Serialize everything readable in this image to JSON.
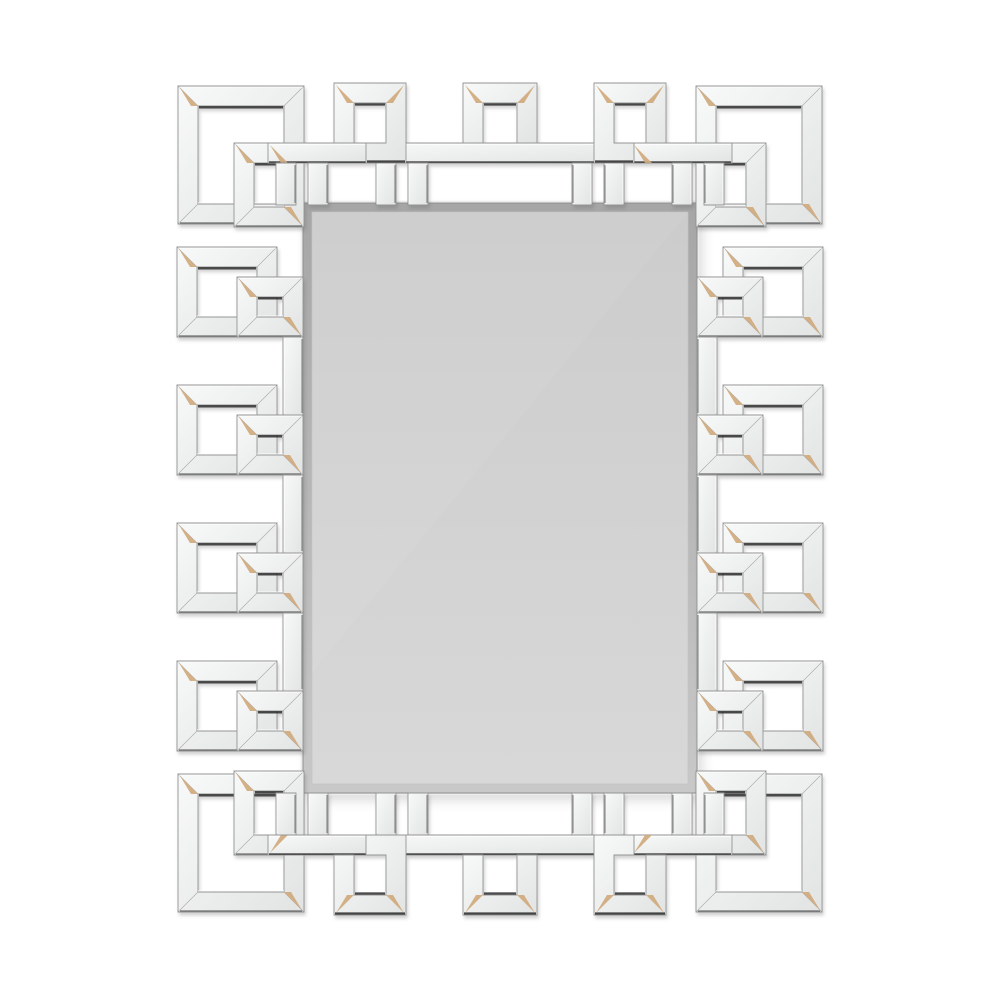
{
  "image": {
    "subject": "rectangular wall mirror with interlocking greek key mirrored fretwork frame on white background",
    "width": 1000,
    "height": 1000
  },
  "colors": {
    "background": "#ffffff",
    "strip_light": "#f8f9f9",
    "strip_dark": "#e2e4e4",
    "edge": "#949494",
    "dark": "#1c1c1c",
    "glint": "#d0a97c",
    "highlight": "#ffffff",
    "bevel_top": "#a6a6a6",
    "bevel_bottom": "#c8c8c8",
    "glass_top": "#cccccc",
    "glass_bottom": "#d8d8d8",
    "mirror_edge": "#8f8f8f"
  },
  "scene": {
    "canvas": {
      "w": 1000,
      "h": 1000
    },
    "strip_width": 20,
    "mirror": {
      "x": 303,
      "y": 203,
      "w": 394,
      "h": 590,
      "bevel": 9
    },
    "squares": [
      [
        178,
        86,
        126,
        138
      ],
      [
        234,
        143,
        70,
        84
      ],
      [
        696,
        86,
        126,
        138
      ],
      [
        696,
        143,
        70,
        84
      ],
      [
        178,
        774,
        126,
        138
      ],
      [
        234,
        771,
        70,
        84
      ],
      [
        696,
        774,
        126,
        138
      ],
      [
        696,
        771,
        70,
        84
      ],
      [
        177,
        247,
        100,
        90
      ],
      [
        177,
        385,
        100,
        90
      ],
      [
        177,
        523,
        100,
        90
      ],
      [
        177,
        661,
        100,
        90
      ],
      [
        237,
        277,
        66,
        60
      ],
      [
        237,
        415,
        66,
        60
      ],
      [
        237,
        553,
        66,
        60
      ],
      [
        237,
        691,
        66,
        60
      ],
      [
        723,
        247,
        100,
        90
      ],
      [
        723,
        385,
        100,
        90
      ],
      [
        723,
        523,
        100,
        90
      ],
      [
        723,
        661,
        100,
        90
      ],
      [
        697,
        277,
        66,
        60
      ],
      [
        697,
        415,
        66,
        60
      ],
      [
        697,
        553,
        66,
        60
      ],
      [
        697,
        691,
        66,
        60
      ]
    ],
    "bars": [
      {
        "r": [
          268,
          143,
          100,
          20
        ],
        "legs": [
          [
            276,
            163,
            20,
            42
          ],
          [
            308,
            163,
            20,
            42
          ]
        ]
      },
      {
        "r": [
          368,
          143,
          264,
          20
        ],
        "legs": [
          [
            376,
            163,
            20,
            42
          ],
          [
            408,
            163,
            20,
            42
          ],
          [
            572,
            163,
            20,
            42
          ],
          [
            604,
            163,
            20,
            42
          ]
        ]
      },
      {
        "r": [
          632,
          143,
          100,
          20
        ],
        "legs": [
          [
            672,
            163,
            20,
            42
          ],
          [
            704,
            163,
            20,
            42
          ]
        ]
      },
      {
        "r": [
          268,
          835,
          100,
          20
        ],
        "legs": [
          [
            276,
            793,
            20,
            42
          ],
          [
            308,
            793,
            20,
            42
          ]
        ]
      },
      {
        "r": [
          368,
          835,
          264,
          20
        ],
        "legs": [
          [
            376,
            793,
            20,
            42
          ],
          [
            408,
            793,
            20,
            42
          ],
          [
            572,
            793,
            20,
            42
          ],
          [
            604,
            793,
            20,
            42
          ]
        ]
      },
      {
        "r": [
          632,
          835,
          100,
          20
        ],
        "legs": [
          [
            672,
            793,
            20,
            42
          ],
          [
            704,
            793,
            20,
            42
          ]
        ]
      },
      {
        "r": [
          283,
          337,
          20,
          78
        ],
        "legs": []
      },
      {
        "r": [
          283,
          475,
          20,
          78
        ],
        "legs": []
      },
      {
        "r": [
          283,
          613,
          20,
          78
        ],
        "legs": []
      },
      {
        "r": [
          697,
          337,
          20,
          78
        ],
        "legs": []
      },
      {
        "r": [
          697,
          475,
          20,
          78
        ],
        "legs": []
      },
      {
        "r": [
          697,
          613,
          20,
          78
        ],
        "legs": []
      }
    ],
    "polys": [
      {
        "pts": [
          [
            334,
            83
          ],
          [
            406,
            83
          ],
          [
            406,
            163
          ],
          [
            366,
            163
          ],
          [
            366,
            143
          ],
          [
            386,
            143
          ],
          [
            386,
            103
          ],
          [
            354,
            103
          ],
          [
            354,
            143
          ],
          [
            334,
            143
          ]
        ],
        "d": [
          [
            355,
            104.5,
            385,
            104.5
          ],
          [
            367,
            161.5,
            405,
            161.5
          ]
        ],
        "g": [
          [
            334,
            83,
            "tl"
          ],
          [
            406,
            83,
            "tr"
          ]
        ]
      },
      {
        "pts": [
          [
            666,
            83
          ],
          [
            594,
            83
          ],
          [
            594,
            163
          ],
          [
            634,
            163
          ],
          [
            634,
            143
          ],
          [
            614,
            143
          ],
          [
            614,
            103
          ],
          [
            646,
            103
          ],
          [
            646,
            143
          ],
          [
            666,
            143
          ]
        ],
        "d": [
          [
            615,
            104.5,
            645,
            104.5
          ],
          [
            595,
            161.5,
            633,
            161.5
          ]
        ],
        "g": [
          [
            666,
            83,
            "tr"
          ],
          [
            594,
            83,
            "tl"
          ]
        ]
      },
      {
        "pts": [
          [
            463,
            83
          ],
          [
            537,
            83
          ],
          [
            537,
            143
          ],
          [
            517,
            143
          ],
          [
            517,
            103
          ],
          [
            483,
            103
          ],
          [
            483,
            143
          ],
          [
            463,
            143
          ]
        ],
        "d": [
          [
            484,
            104.5,
            516,
            104.5
          ]
        ],
        "g": [
          [
            463,
            83,
            "tl"
          ],
          [
            537,
            83,
            "tr"
          ]
        ]
      },
      {
        "pts": [
          [
            334,
            915
          ],
          [
            406,
            915
          ],
          [
            406,
            835
          ],
          [
            366,
            835
          ],
          [
            366,
            855
          ],
          [
            386,
            855
          ],
          [
            386,
            895
          ],
          [
            354,
            895
          ],
          [
            354,
            855
          ],
          [
            334,
            855
          ]
        ],
        "d": [
          [
            355,
            893.5,
            385,
            893.5
          ],
          [
            335,
            913.5,
            405,
            913.5
          ]
        ],
        "g": [
          [
            334,
            915,
            "bl"
          ],
          [
            406,
            915,
            "br"
          ]
        ]
      },
      {
        "pts": [
          [
            666,
            915
          ],
          [
            594,
            915
          ],
          [
            594,
            835
          ],
          [
            634,
            835
          ],
          [
            634,
            855
          ],
          [
            614,
            855
          ],
          [
            614,
            895
          ],
          [
            646,
            895
          ],
          [
            646,
            855
          ],
          [
            666,
            855
          ]
        ],
        "d": [
          [
            615,
            893.5,
            645,
            893.5
          ],
          [
            595,
            913.5,
            665,
            913.5
          ]
        ],
        "g": [
          [
            666,
            915,
            "br"
          ],
          [
            594,
            915,
            "bl"
          ]
        ]
      },
      {
        "pts": [
          [
            463,
            915
          ],
          [
            537,
            915
          ],
          [
            537,
            855
          ],
          [
            517,
            855
          ],
          [
            517,
            895
          ],
          [
            483,
            895
          ],
          [
            483,
            855
          ],
          [
            463,
            855
          ]
        ],
        "d": [
          [
            484,
            893.5,
            516,
            893.5
          ],
          [
            464,
            913.5,
            536,
            913.5
          ]
        ],
        "g": [
          [
            463,
            915,
            "bl"
          ],
          [
            537,
            915,
            "br"
          ]
        ]
      }
    ]
  }
}
